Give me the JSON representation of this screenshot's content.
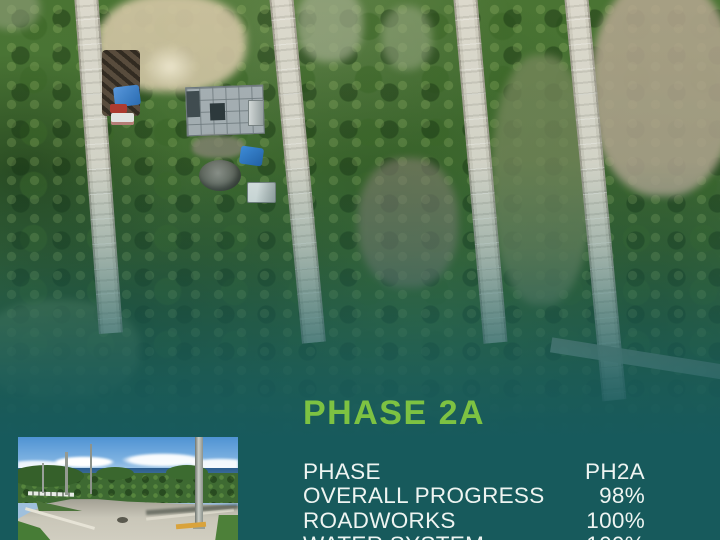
{
  "colors": {
    "background_teal": "#175A5C",
    "title_green": "#7DC242",
    "stats_text": "#EEF4F1"
  },
  "title": "PHASE 2A",
  "stats": {
    "rows": [
      {
        "label": "PHASE",
        "value": "PH2A"
      },
      {
        "label": "OVERALL PROGRESS",
        "value": "98%"
      },
      {
        "label": "ROADWORKS",
        "value": "100%"
      },
      {
        "label": "WATER SYSTEM",
        "value": "100%"
      }
    ]
  }
}
